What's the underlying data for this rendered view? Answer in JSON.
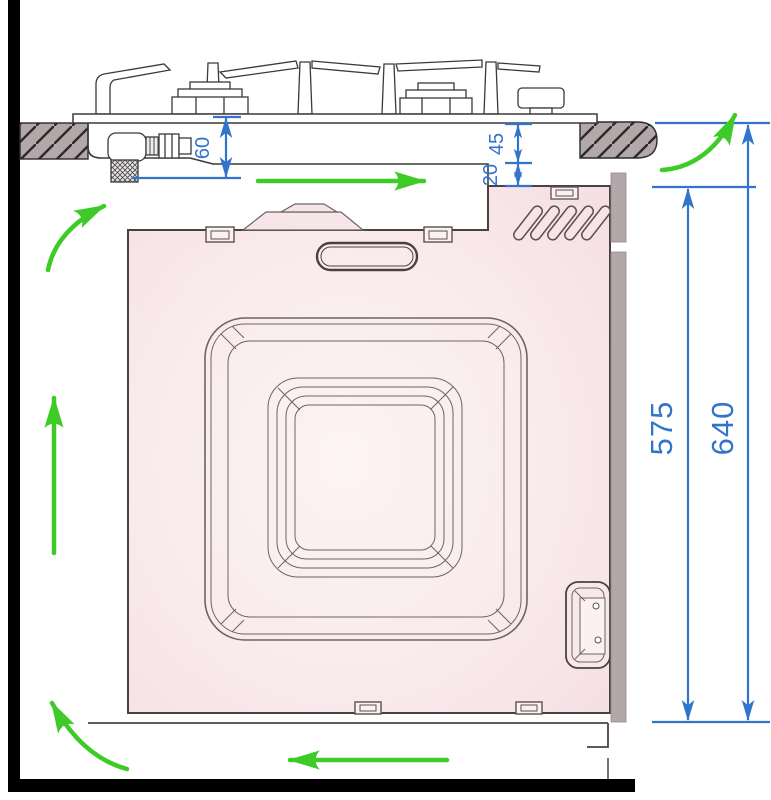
{
  "diagram": {
    "kind": "built-in-oven-and-gas-hob-installation-clearances",
    "dims": {
      "d60": "60",
      "d45": "45",
      "d20": "20",
      "d575": "575",
      "d640": "640"
    },
    "colors": {
      "dimension_blue": "#3273cc",
      "airflow_green": "#3ecb28",
      "oven_pink_edge": "#f5dfe3",
      "oven_pink_center": "#fdf4f5",
      "cabinet_gray": "#b3a7a9",
      "outline_dark": "#4a4242",
      "wall_black": "#000000"
    },
    "airflow_arrows": [
      {
        "name": "under-hob-arrow",
        "direction": "right"
      },
      {
        "name": "upper-left-curve-arrow",
        "direction": "up-right"
      },
      {
        "name": "left-vertical-arrow",
        "direction": "up"
      },
      {
        "name": "lower-left-curve-arrow",
        "direction": "up"
      },
      {
        "name": "bottom-arrow",
        "direction": "left"
      },
      {
        "name": "upper-right-curve-arrow",
        "direction": "up"
      }
    ]
  }
}
